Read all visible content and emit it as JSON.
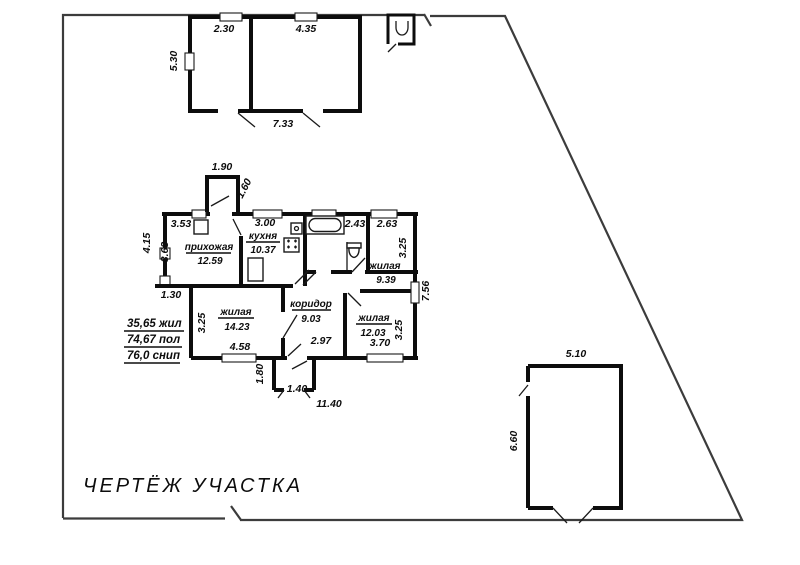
{
  "title": "ЧЕРТЁЖ  УЧАСТКА",
  "area_summary": {
    "living": "35,65 жил",
    "useful": "74,67 пол",
    "snip": "76,0 снип"
  },
  "shed": {
    "width_left_room": "2.30",
    "width_right_room": "4.35",
    "height": "5.30",
    "width_total": "7.33"
  },
  "garage": {
    "width": "5.10",
    "height": "6.60"
  },
  "house": {
    "entry_porch": {
      "width": "1.90",
      "depth": "1.60"
    },
    "rear_porch": {
      "depth": "1.80",
      "width": "1.40"
    },
    "dims": {
      "left_height": "4.15",
      "left_step": "1.30",
      "right_height": "7.56",
      "total_width": "11.40"
    },
    "rooms": {
      "hallway": {
        "name": "прихожая",
        "area": "12.59",
        "width": "3.53",
        "height": "3.63"
      },
      "kitchen": {
        "name": "кухня",
        "area": "10.37",
        "width": "3.00"
      },
      "bathroom": {
        "width": "2.43"
      },
      "living_small": {
        "name": "жилая",
        "area": "9.39",
        "width": "2.63",
        "height": "3.25"
      },
      "living_mid": {
        "name": "жилая",
        "area": "14.23",
        "width": "4.58",
        "height": "3.25"
      },
      "corridor": {
        "name": "коридор",
        "area": "9.03",
        "width": "2.97"
      },
      "living_right": {
        "name": "жилая",
        "area": "12.03",
        "width": "3.70",
        "height": "3.25"
      }
    }
  },
  "colors": {
    "walls": "#0d0d0d",
    "boundary": "#3c3c3c",
    "background": "#ffffff"
  }
}
